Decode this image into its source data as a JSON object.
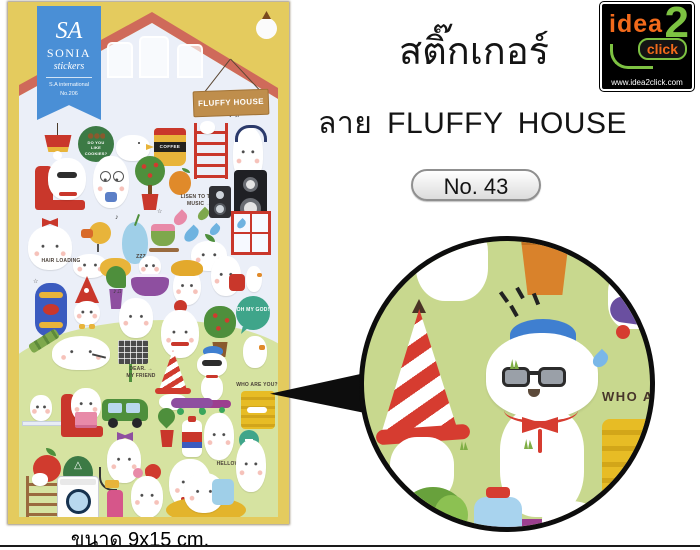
{
  "right_panel": {
    "title": "สติ๊กเกอร์",
    "subtitle": "ลาย FLUFFY HOUSE",
    "badge": "No. 43"
  },
  "logo": {
    "idea": "idea",
    "two": "2",
    "click": "click",
    "url": "www.idea2click.com"
  },
  "sheet": {
    "ribbon": {
      "monogram": "SA",
      "brand": "SONIA",
      "type": "stickers",
      "sub1": "S.A international",
      "sub2": "No.206"
    },
    "sign": "FLUFFY HOUSE",
    "labels": {
      "cookies": "DO YOU LIKE COOKIES?",
      "coffee": "COFFEE",
      "listen1": "LISEN TO THE",
      "listen2": "MUSIC →",
      "hair_loading": "HAIR LOADING",
      "zzz": "ZZZ",
      "oh_my_god": "OH MY GOD!",
      "dear1": "DEAR. →",
      "dear2": "MY FRIEND",
      "who_are_you": "WHO ARE YOU?",
      "hellow": "HELLOW!"
    }
  },
  "magnifier": {
    "partial_text": "WHO ARE"
  },
  "caption": "ขนาด 9x15 cm.",
  "colors": {
    "sheet_yellow": "#e4cb5e",
    "roof_red": "#cf6a5a",
    "ribbon_blue": "#4a8fd6",
    "hill_green": "#d6e3a1",
    "magnifier_green": "#c8d88e",
    "logo_orange": "#f26a1b",
    "logo_green": "#7dc242"
  }
}
